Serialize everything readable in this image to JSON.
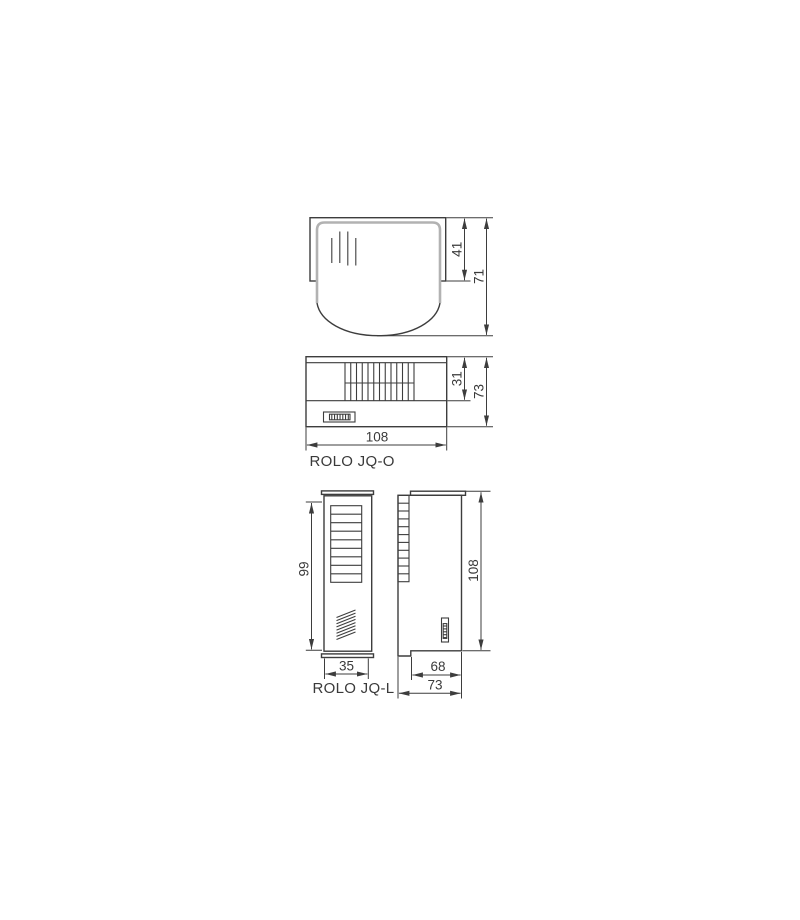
{
  "page": {
    "background": "#ffffff"
  },
  "colors": {
    "line": "#3d3d3d",
    "text": "#3a3a3a",
    "cover_outline": "#b2b2b2"
  },
  "products": {
    "jq_o": {
      "label": "ROLO JQ-O",
      "top_view": {
        "dim_cover_depth": "41",
        "dim_total_depth": "71"
      },
      "front_view": {
        "dim_grille_height": "31",
        "dim_height": "73",
        "dim_width": "108"
      }
    },
    "jq_l": {
      "label": "ROLO JQ-L",
      "front_view": {
        "dim_height": "99",
        "dim_width": "35"
      },
      "side_view": {
        "dim_height": "108",
        "dim_body_depth": "68",
        "dim_total_depth": "73"
      }
    }
  }
}
